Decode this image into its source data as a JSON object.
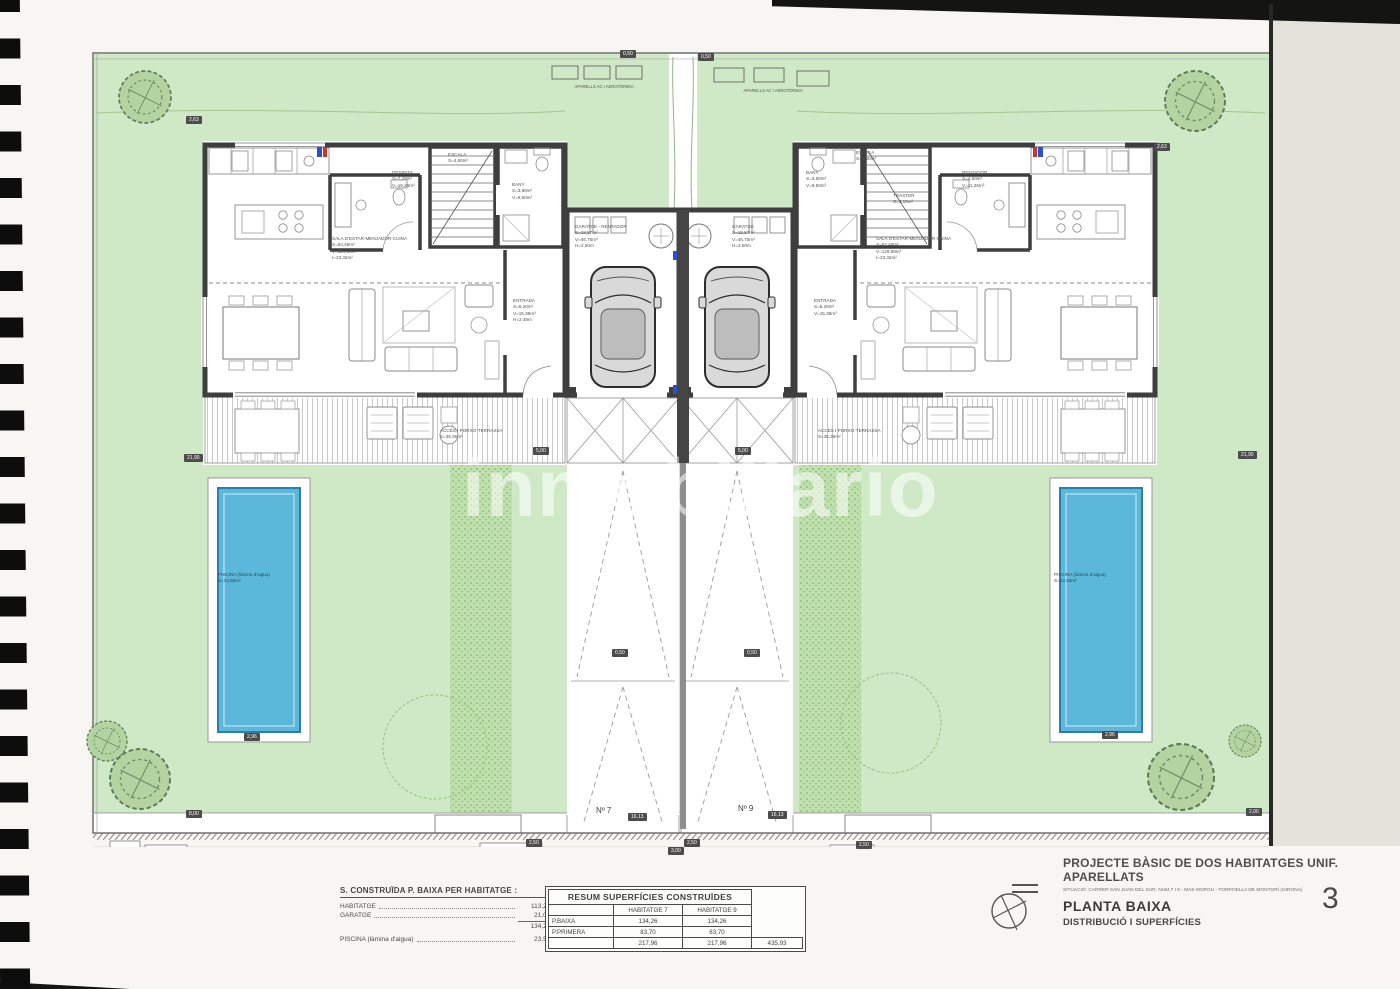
{
  "title_block": {
    "project": "PROJECTE BÀSIC DE DOS HABITATGES UNIF. APARELLATS",
    "situation": "SITUACIÓ: CARRER SAN JUAN DEL SUR, NUM.7 I 9 - MAS MORGU - TORROELLA DE MONTGRÍ (GIRONA)",
    "sheet_title": "PLANTA BAIXA",
    "sheet_subtitle": "DISTRIBUCIÓ I SUPERFÍCIES",
    "page_number": "3"
  },
  "summary_left": {
    "title": "S. CONSTRUÏDA P. BAIXA PER HABITATGE :",
    "rows": [
      {
        "label": "HABITATGE",
        "value": "113,26m²"
      },
      {
        "label": "GARATGE",
        "value": "21,00m²"
      }
    ],
    "subtotal": "134,26m²",
    "pool_label": "PISCINA (làmina d'aigua)",
    "pool_value": "23,55m²"
  },
  "table": {
    "title": "RESUM SUPERFÍCIES CONSTRUÏDES",
    "col_h7": "HABITATGE 7",
    "col_h9": "HABITATGE 9",
    "rows": [
      {
        "label": "P.BAIXA",
        "h7": "134,26",
        "h9": "134,26",
        "total": ""
      },
      {
        "label": "P.PRIMERA",
        "h7": "83,70",
        "h9": "83,70",
        "total": ""
      },
      {
        "label": "",
        "h7": "217,96",
        "h9": "217,96",
        "total": "435,93"
      }
    ]
  },
  "plan": {
    "house7_number": "Nº 7",
    "house9_number": "Nº 9",
    "watermark": "inmobiliario",
    "labels": {
      "aparells_left": "APARELLS AC I AEROTÈRMIA",
      "aparells_right": "APARELLS AC I AEROTÈRMIA",
      "sala7": "SALA D'ESTAR-MENJADOR-CUINA\nS=53,48m²\nV=129,88m³\nI=23,32m²",
      "despatx7": "DESPATX\nS=7,29m²\nV=19,28m³",
      "escala7": "ESCALA\nS=4,60m²",
      "bany7": "BANY\nS=3,80m²\nV=9,50m³",
      "garatge7": "GARATGE - RENTADOR\nS=18,57m²\nV=46,75m³\nH=2,50m",
      "entrada7": "ENTRADA\nS=6,20m²\nV=15,38m³\nH=2,48m",
      "acces7": "ACCÉS I PORXO-TERRASSA\nS=35,36m²",
      "piscina7": "PISCINA (làmina d'aigua)\nS=23,55m²",
      "bany9": "BANY\nS=3,80m²\nV=9,50m³",
      "escala9": "ESCALA\nS=4,60m²",
      "traster9": "TRASTER\nS=3,10m²",
      "rentador9": "RENTADOR\nS=4,50m²\nV=11,25m³",
      "garatge9": "GARATGE\nS=18,57m²\nV=46,75m³\nH=2,50m",
      "sala9": "SALA D'ESTAR-MENJADOR-CUINA\nS=53,48m²\nV=129,88m³\nI=23,32m²",
      "entrada9": "ENTRADA\nS=6,20m²\nV=15,38m³",
      "acces9": "ACCÉS I PORXO-TERRASSA\nS=35,36m²",
      "piscina9": "PISCINA (làmina d'aigua)\nS=23,55m²"
    },
    "tags": [
      {
        "t": "0,50",
        "x": 620,
        "y": 50
      },
      {
        "t": "0,50",
        "x": 698,
        "y": 53
      },
      {
        "t": "2,63",
        "x": 186,
        "y": 116
      },
      {
        "t": "2,63",
        "x": 1154,
        "y": 143
      },
      {
        "t": "21,90",
        "x": 184,
        "y": 454
      },
      {
        "t": "21,90",
        "x": 1238,
        "y": 451
      },
      {
        "t": "5,00",
        "x": 533,
        "y": 447
      },
      {
        "t": "5,00",
        "x": 735,
        "y": 447
      },
      {
        "t": "0,50",
        "x": 612,
        "y": 649
      },
      {
        "t": "0,50",
        "x": 744,
        "y": 649
      },
      {
        "t": "16,13",
        "x": 628,
        "y": 813
      },
      {
        "t": "16,13",
        "x": 768,
        "y": 811
      },
      {
        "t": "2,50",
        "x": 526,
        "y": 839
      },
      {
        "t": "2,50",
        "x": 684,
        "y": 839
      },
      {
        "t": "2,50",
        "x": 856,
        "y": 841
      },
      {
        "t": "3,00",
        "x": 668,
        "y": 847
      },
      {
        "t": "2,96",
        "x": 244,
        "y": 733
      },
      {
        "t": "2,96",
        "x": 1102,
        "y": 731
      },
      {
        "t": "8,00",
        "x": 186,
        "y": 810
      },
      {
        "t": "2,00",
        "x": 1246,
        "y": 808
      }
    ]
  },
  "colors": {
    "garden_green": "#cfe8c5",
    "pool_blue": "#5cb8da",
    "wall_gray": "#3e3e3e"
  }
}
